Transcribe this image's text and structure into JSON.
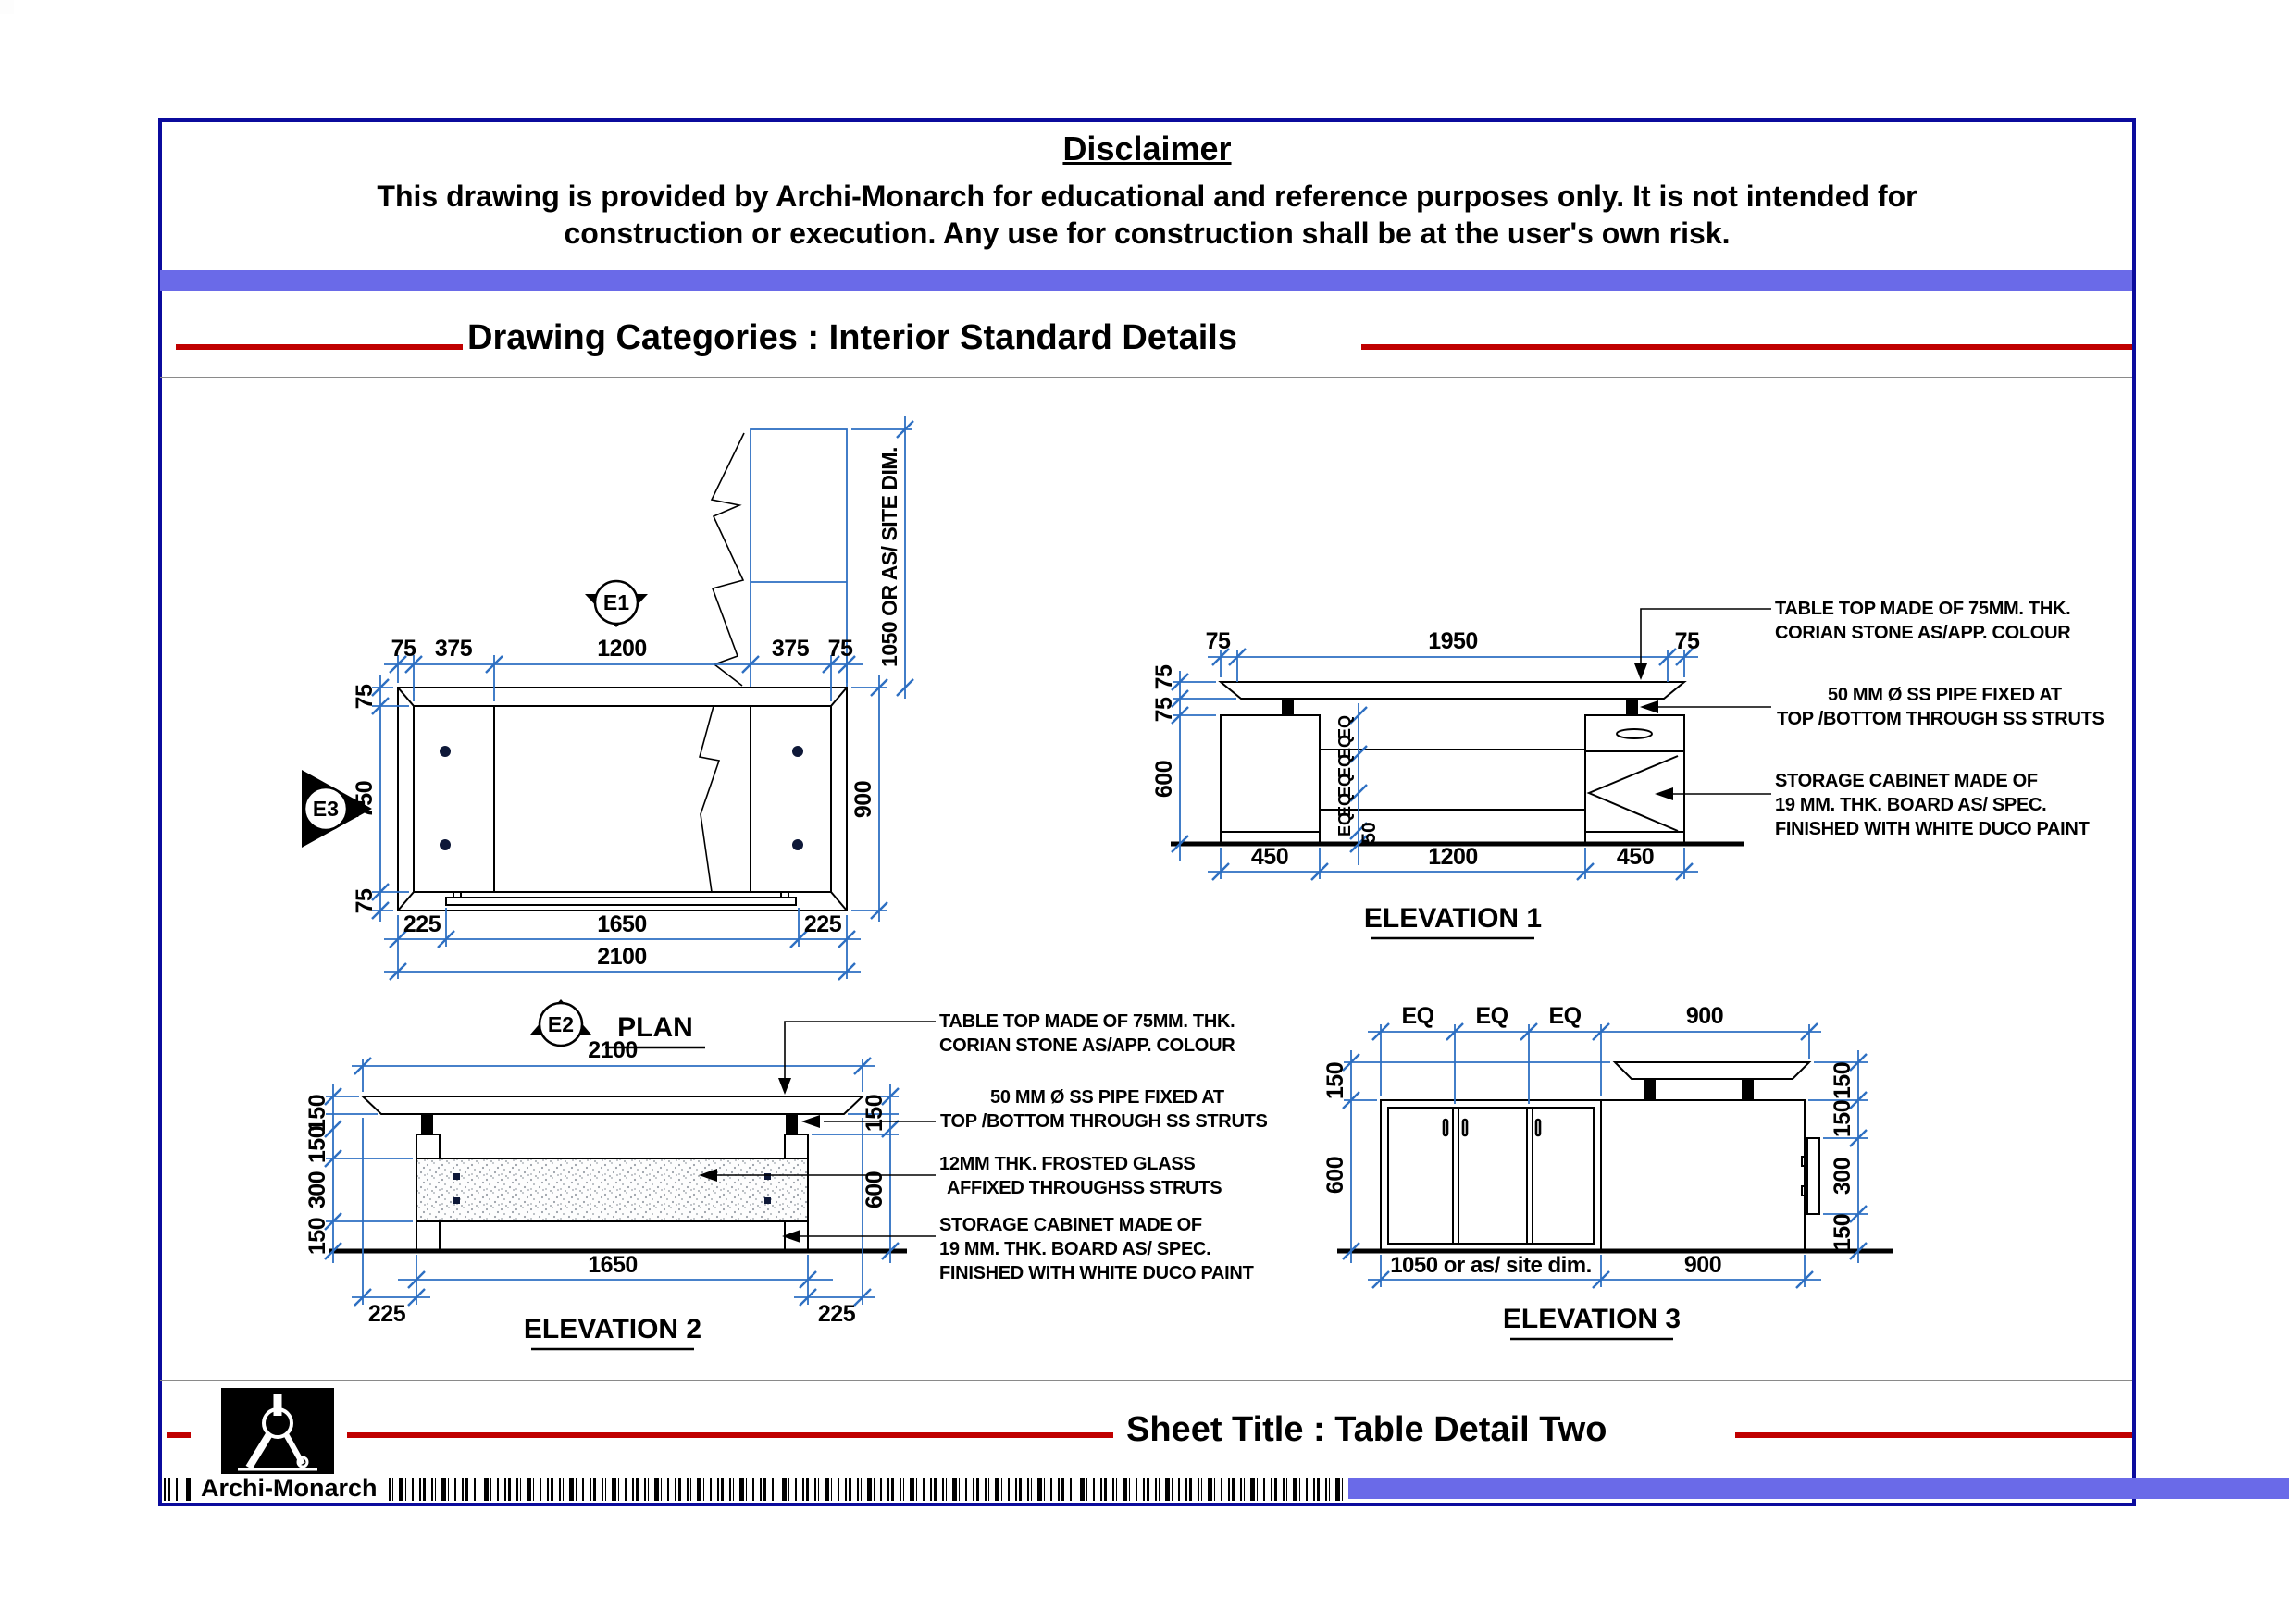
{
  "header": {
    "disclaimer_title": "Disclaimer",
    "disclaimer_line1": "This drawing is provided by Archi-Monarch for educational and reference purposes only. It is not intended for",
    "disclaimer_line2": "construction or execution. Any use for construction shall be at the user's own risk.",
    "category_title": "Drawing Categories : Interior Standard Details"
  },
  "footer": {
    "sheet_title": "Sheet Title : Table Detail Two",
    "brand": "Archi-Monarch"
  },
  "colors": {
    "accent_purple": "#6a6ae8",
    "accent_red": "#c00000",
    "dimension_blue": "#2d6fc2",
    "frame_blue": "#0b0b9d"
  },
  "plan": {
    "label": "PLAN",
    "markers": {
      "e1": "E1",
      "e2": "E2",
      "e3": "E3"
    },
    "dim_top": [
      "75",
      "375",
      "1200",
      "375",
      "75"
    ],
    "dim_left": [
      "75",
      "750",
      "75"
    ],
    "dim_bottom": [
      "225",
      "1650",
      "225"
    ],
    "dim_total": "2100",
    "dim_right": "900",
    "dim_side": "1050 OR AS/ SITE DIM."
  },
  "elev1": {
    "label": "ELEVATION 1",
    "dim_top": [
      "75",
      "1950",
      "75"
    ],
    "dim_left": [
      "75",
      "75",
      "600"
    ],
    "dim_mid": [
      "EQ",
      "EQ",
      "EQ",
      "EQ",
      "EQ",
      "EQ",
      "50"
    ],
    "dim_bottom": [
      "450",
      "1200",
      "450"
    ],
    "notes": {
      "n1": [
        "TABLE TOP MADE OF 75MM. THK.",
        "CORIAN STONE AS/APP. COLOUR"
      ],
      "n2": [
        "50 MM Ø SS PIPE FIXED AT",
        "TOP /BOTTOM THROUGH SS STRUTS"
      ],
      "n3": [
        "STORAGE CABINET MADE OF",
        "19 MM. THK. BOARD AS/ SPEC.",
        "FINISHED WITH WHITE DUCO PAINT"
      ]
    }
  },
  "elev2": {
    "label": "ELEVATION 2",
    "dim_top": "2100",
    "dim_left": [
      "150",
      "150",
      "300",
      "150"
    ],
    "dim_right": [
      "150",
      "600"
    ],
    "dim_bottom": [
      "225",
      "1650",
      "225"
    ],
    "notes": {
      "n1": [
        "TABLE TOP MADE OF 75MM. THK.",
        "CORIAN STONE AS/APP. COLOUR"
      ],
      "n2": [
        "50 MM Ø SS PIPE FIXED AT",
        "TOP /BOTTOM THROUGH SS STRUTS"
      ],
      "n3": [
        "12MM THK. FROSTED GLASS",
        "AFFIXED THROUGHSS STRUTS"
      ],
      "n4": [
        "STORAGE CABINET MADE OF",
        "19 MM. THK. BOARD AS/ SPEC.",
        "FINISHED WITH WHITE DUCO PAINT"
      ]
    }
  },
  "elev3": {
    "label": "ELEVATION 3",
    "dim_top": [
      "EQ",
      "EQ",
      "EQ",
      "900"
    ],
    "dim_left": [
      "150",
      "600"
    ],
    "dim_right": [
      "150",
      "150",
      "300",
      "150"
    ],
    "dim_bottom": [
      "1050 or as/ site dim.",
      "900"
    ]
  }
}
